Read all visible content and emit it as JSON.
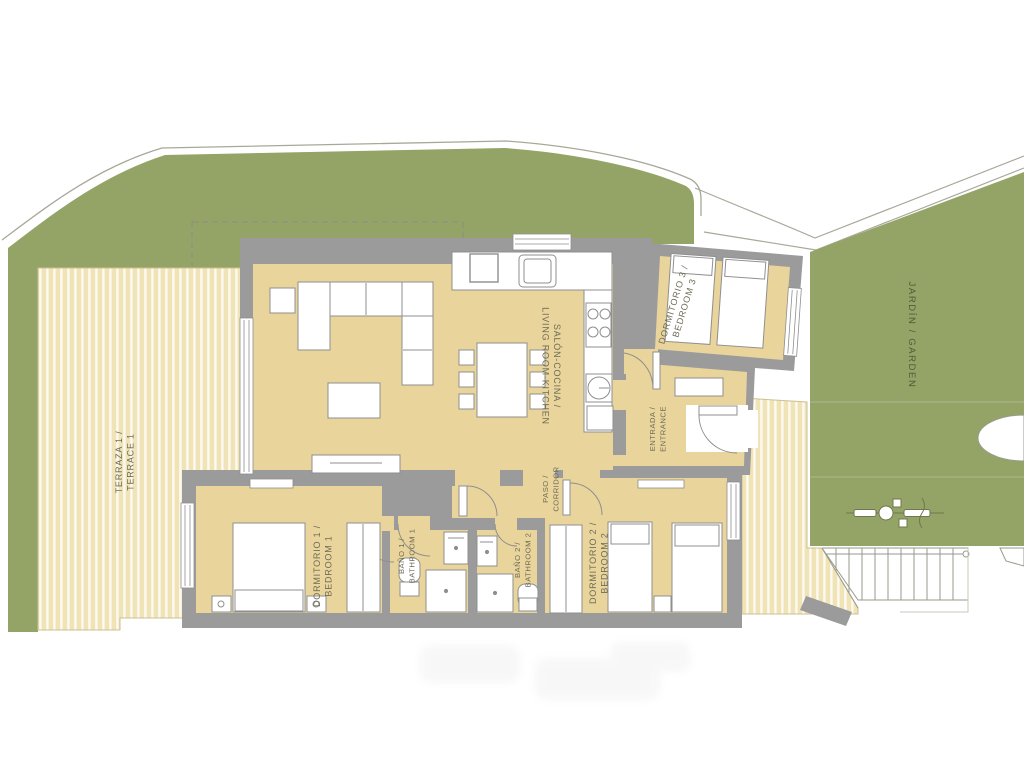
{
  "plan": {
    "labels": {
      "terraza": {
        "line1": "TERRAZA 1 /",
        "line2": "TERRACE 1"
      },
      "salon": {
        "line1": "SALÓN-COCINA /",
        "line2": "LIVING ROOM-KITCHEN"
      },
      "dormitorio1": {
        "line1": "DORMITORIO 1 /",
        "line2": "BEDROOM 1"
      },
      "dormitorio2": {
        "line1": "DORMITORIO 2 /",
        "line2": "BEDROOM 2"
      },
      "dormitorio3": {
        "line1": "DORMITORIO 3 /",
        "line2": "BEDROOM 3"
      },
      "bano1": {
        "line1": "BAÑO 1 /",
        "line2": "BATHROOM 1"
      },
      "bano2": {
        "line1": "BAÑO 2 /",
        "line2": "BATHROOM 2"
      },
      "paso": {
        "line1": "PASO /",
        "line2": "CORRIDOR"
      },
      "entrada": {
        "line1": "ENTRADA /",
        "line2": "ENTRANCE"
      },
      "jardin": {
        "line1": "JARDÍN / GARDEN"
      }
    },
    "colors": {
      "garden_green": "#93a466",
      "floor_tan": "#e9d49c",
      "terrace_cream": "#f0e3b6",
      "terrace_stripe": "#fcfaf1",
      "wall_gray": "#9b9b9b",
      "outline_gray": "#8f8f8f",
      "label_text": "#6e6c57"
    }
  }
}
